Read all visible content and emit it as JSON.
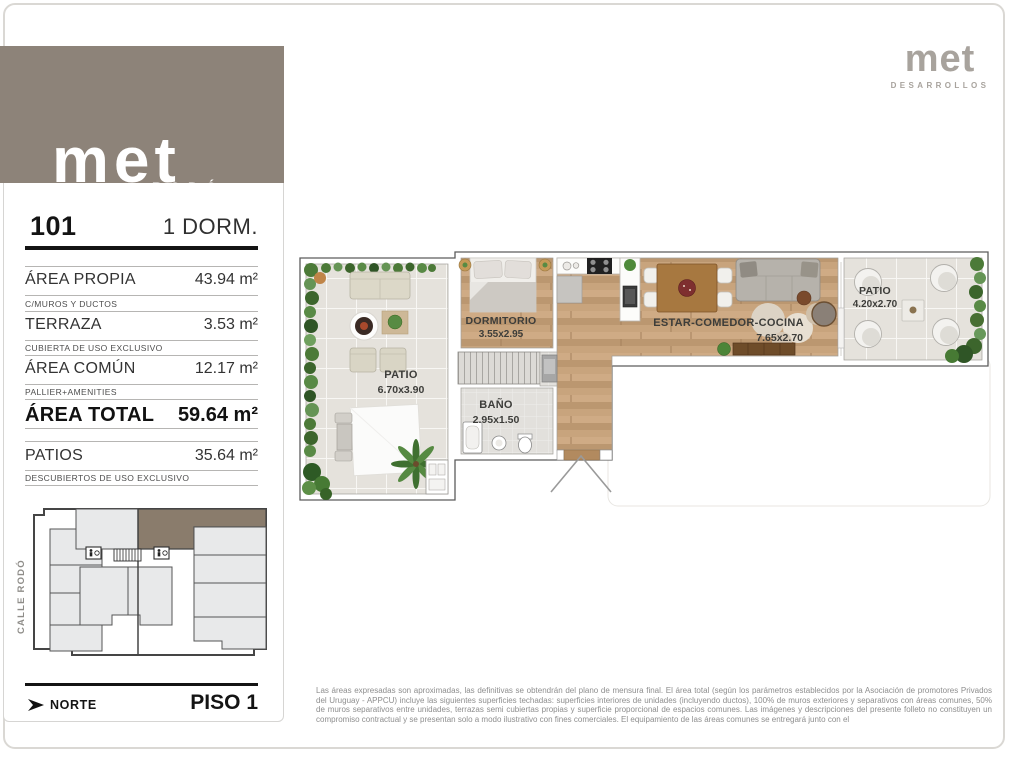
{
  "colors": {
    "brand-taupe": "#8d8379",
    "logo-gray": "#a8a39d",
    "keyplan-highlight": "#8a7c6c",
    "ink": "#1c1c1c",
    "muted": "#8e8e8e"
  },
  "branding": {
    "project_logo": "met",
    "project_name": "RODÓ",
    "developer_logo": "met",
    "developer_name": "DESARROLLOS"
  },
  "sidebar": {
    "unit_number": "101",
    "unit_type": "1 DORM.",
    "areas": [
      {
        "label": "ÁREA PROPIA",
        "value": "43.94 m²",
        "note": "C/MUROS Y DUCTOS"
      },
      {
        "label": "TERRAZA",
        "value": "3.53 m²",
        "note": "CUBIERTA DE USO EXCLUSIVO"
      },
      {
        "label": "ÁREA COMÚN",
        "value": "12.17 m²",
        "note": "PALLIER+AMENITIES"
      },
      {
        "label": "ÁREA TOTAL",
        "value": "59.64 m²",
        "note": ""
      },
      {
        "label": "PATIOS",
        "value": "35.64 m²",
        "note": "DESCUBIERTOS DE USO EXCLUSIVO"
      }
    ],
    "street_label": "CALLE RODÓ",
    "north_label": "NORTE",
    "floor_label": "PISO 1"
  },
  "floorplan": {
    "rooms": [
      {
        "name": "PATIO",
        "dims": "6.70x3.90"
      },
      {
        "name": "DORMITORIO",
        "dims": "3.55x2.95"
      },
      {
        "name": "BAÑO",
        "dims": "2.95x1.50"
      },
      {
        "name": "ESTAR-COMEDOR-COCINA",
        "dims": "7.65x2.70"
      },
      {
        "name": "PATIO",
        "dims": "4.20x2.70"
      }
    ]
  },
  "footer": {
    "disclaimer": "Las áreas expresadas son aproximadas, las definitivas se obtendrán del plano de mensura final. El área total (según los parámetros establecidos por la Asociación de promotores Privados del Uruguay - APPCU) incluye las siguientes superficies techadas: superficies interiores de unidades (incluyendo ductos), 100% de muros exteriores y separativos con áreas comunes, 50% de muros separativos entre unidades, terrazas semi cubiertas propias y superficie proporcional de espacios comunes.  Las imágenes y descripciones del presente folleto no constituyen un compromiso contractual y se presentan solo a modo ilustrativo con fines comerciales. El equipamiento de las áreas comunes se entregará junto con el"
  }
}
